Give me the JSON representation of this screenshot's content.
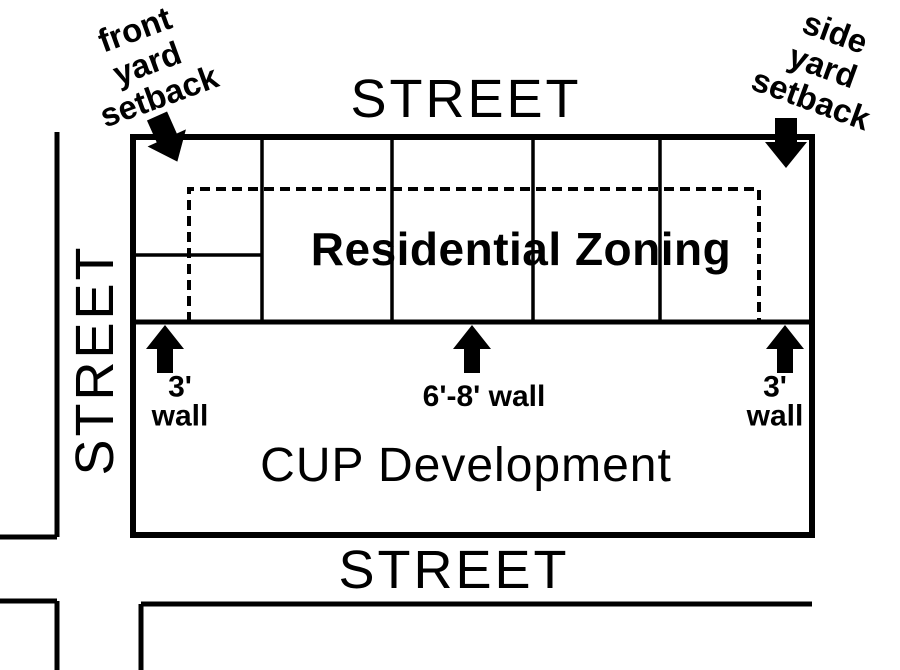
{
  "canvas": {
    "width": 900,
    "height": 670,
    "background": "#ffffff",
    "ink": "#000000"
  },
  "streets": {
    "top_label": "STREET",
    "left_label": "STREET",
    "bottom_label": "STREET"
  },
  "parcel": {
    "residential_zone_label": "Residential Zoning",
    "cup_zone_label": "CUP Development"
  },
  "annotations": {
    "front_setback": {
      "lines": [
        "front",
        "yard",
        "setback"
      ]
    },
    "side_setback": {
      "lines": [
        "side",
        "yard",
        "setback"
      ]
    },
    "wall_left": {
      "lines": [
        "3'",
        "wall"
      ]
    },
    "wall_center": {
      "text": "6'-8' wall"
    },
    "wall_right": {
      "lines": [
        "3'",
        "wall"
      ]
    }
  },
  "icons": {
    "front_setback_arrow": "down-right-block-arrow",
    "side_setback_arrow": "down-block-arrow",
    "wall_arrows": "up-block-arrow"
  }
}
